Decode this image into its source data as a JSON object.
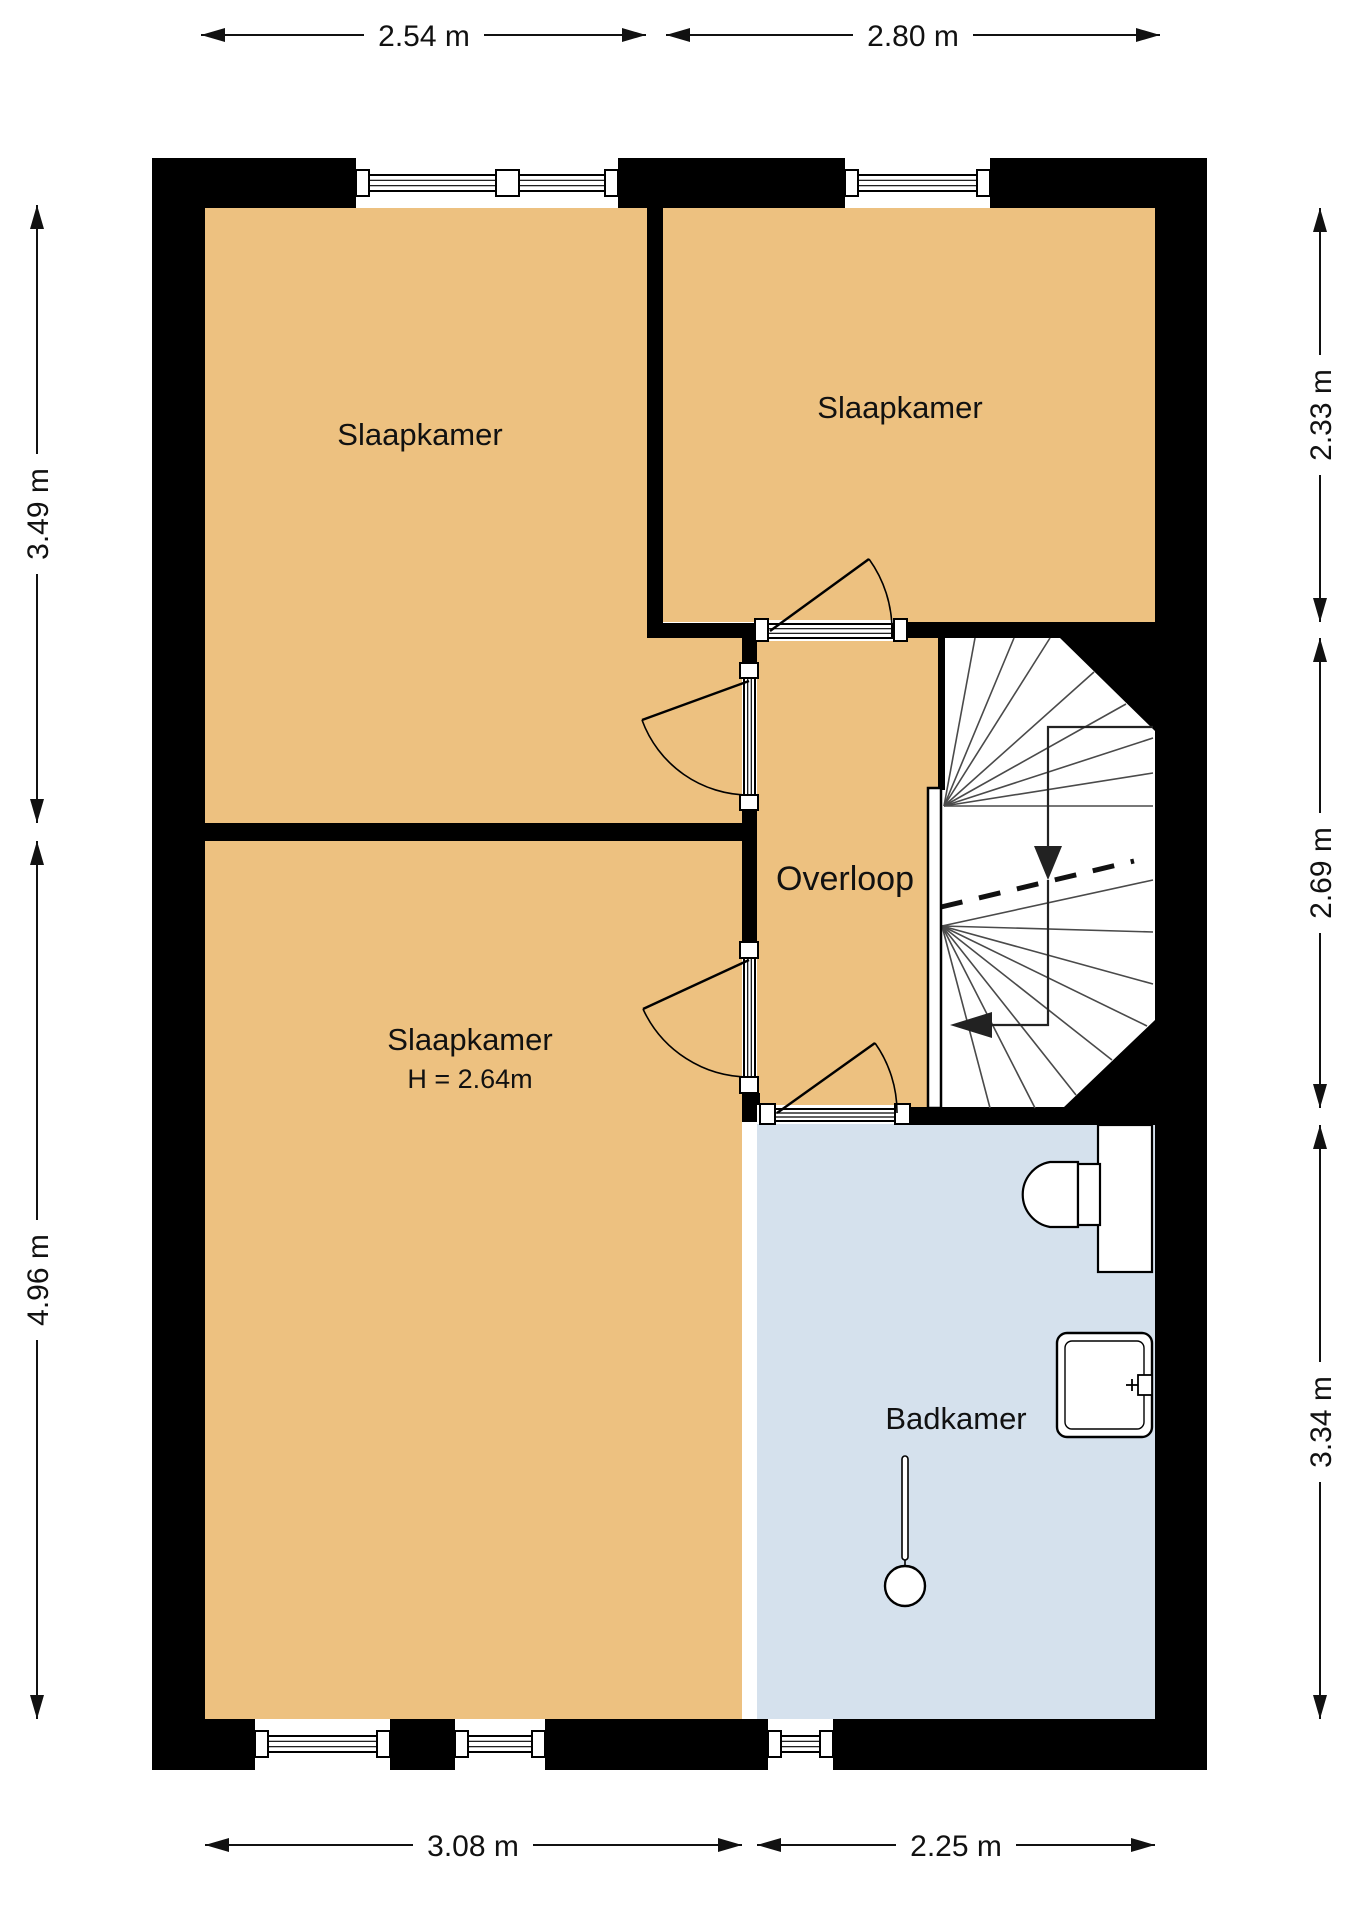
{
  "plan": {
    "rooms": [
      {
        "id": "bedroom-top-left",
        "label": "Slaapkamer"
      },
      {
        "id": "bedroom-top-right",
        "label": "Slaapkamer"
      },
      {
        "id": "bedroom-bottom-left",
        "label": "Slaapkamer",
        "height_note": "H = 2.64m"
      },
      {
        "id": "landing",
        "label": "Overloop"
      },
      {
        "id": "bathroom",
        "label": "Badkamer"
      }
    ],
    "dimensions": {
      "top": [
        "2.54 m",
        "2.80 m"
      ],
      "left": [
        "3.49 m",
        "4.96 m"
      ],
      "right": [
        "2.33 m",
        "2.69 m",
        "3.34 m"
      ],
      "bottom": [
        "3.08 m",
        "2.25 m"
      ]
    },
    "fixtures": [
      "staircase",
      "stair-handrail",
      "toilet",
      "sink",
      "shower-head"
    ],
    "colors": {
      "wall": "#000000",
      "bedroom_floor": "#edc180",
      "bathroom_floor": "#d5e1ed",
      "background": "#ffffff",
      "stair_line": "#4a4a4a",
      "text": "#111111"
    }
  }
}
